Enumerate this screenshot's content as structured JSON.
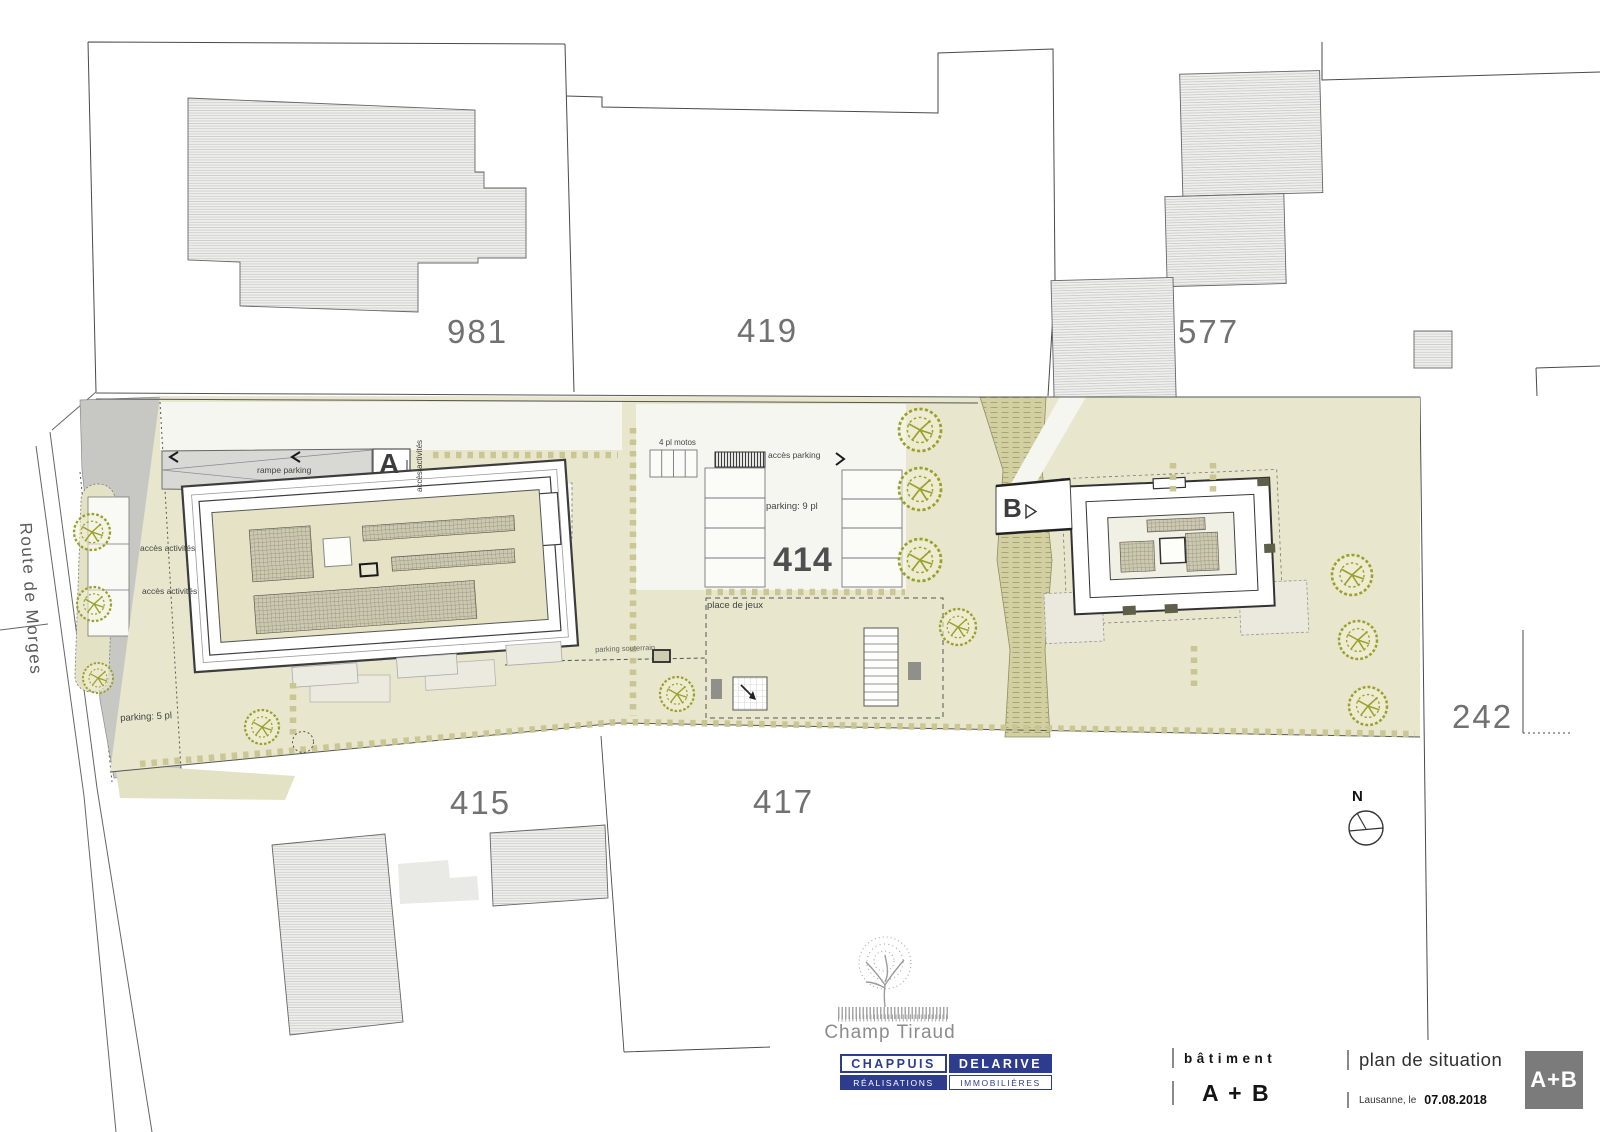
{
  "plan": {
    "street": "Route de Morges",
    "north_label": "N",
    "parcels": {
      "p981": "981",
      "p419": "419",
      "p577": "577",
      "p414": "414",
      "p415": "415",
      "p417": "417",
      "p242": "242"
    },
    "annotations": {
      "rampe_parking": "rampe parking",
      "acces_activites": "accès activités",
      "parking_5": "parking: 5 pl",
      "motos_4": "4 pl motos",
      "acces_parking": "accès parking",
      "parking_9": "parking: 9 pl",
      "place_de_jeux": "place de jeux",
      "parking_souterrain": "parking souterrain",
      "building_a_mark": "A",
      "building_b_mark": "B"
    }
  },
  "title_block": {
    "project_logo_name": "Champ Tiraud",
    "company": {
      "top_left": "CHAPPUIS",
      "top_right": "DELARIVE",
      "bottom_left": "RÉALISATIONS",
      "bottom_right": "IMMOBILIÈRES"
    },
    "building_label": "bâtiment",
    "building_value": "A + B",
    "drawing_title": "plan de situation",
    "place_date_label": "Lausanne, le",
    "date": "07.08.2018",
    "badge": "A+B"
  },
  "colors": {
    "site_green": "#e8e6cd",
    "slope_olive": "#d2cfa0",
    "road_gray": "#c7c7c4",
    "tree_green": "#9aa02c",
    "logo_blue": "#2e3c8e",
    "badge_gray": "#7b7b7b"
  }
}
